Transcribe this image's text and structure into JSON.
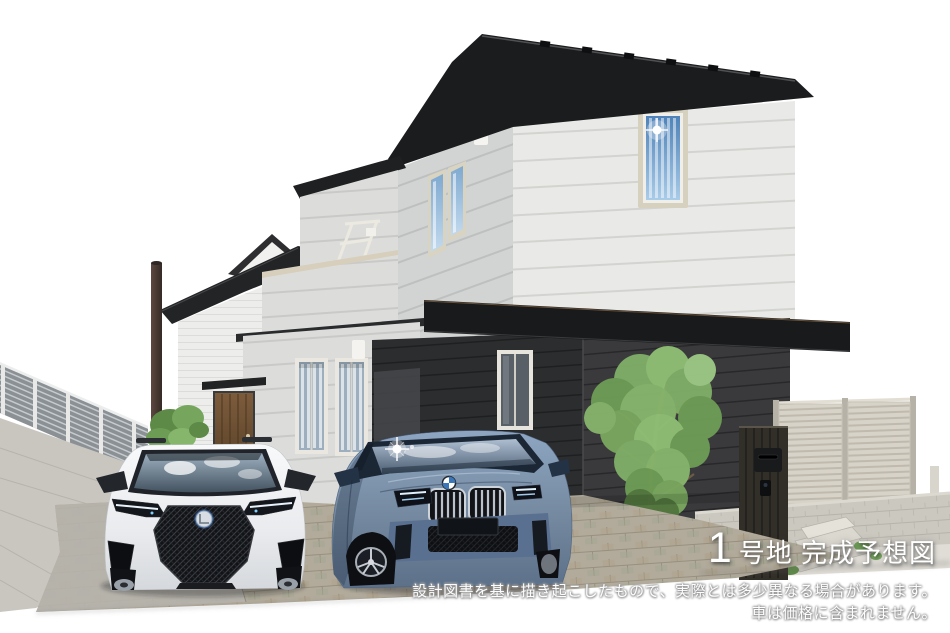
{
  "meta": {
    "canvas_width": 950,
    "canvas_height": 633,
    "background": "#ffffff"
  },
  "caption": {
    "lot_number": "1",
    "label": "号地 完成予想図"
  },
  "disclaimer": {
    "line1": "設計図書を基に描き起こしたもので、実際とは多少異なる場合があります。",
    "line2": "車は価格に含まれません。"
  },
  "colors": {
    "siding_light": "#e8e9e7",
    "siding_shaded": "#d2d4d3",
    "first_floor_dark_wall": "#39393b",
    "roof": "#1b1c1e",
    "entrance_door": "#6b4e2f",
    "left_fence": "#8f9397",
    "right_fence": "#d8d3c8",
    "gate_post": "#322e28",
    "foliage": "#7fae67",
    "driveway_paver": "#b2ab9c",
    "car_left_body": "#f4f5f6",
    "car_right_body": "#7d93b1",
    "caption_text": "#ffffff"
  }
}
